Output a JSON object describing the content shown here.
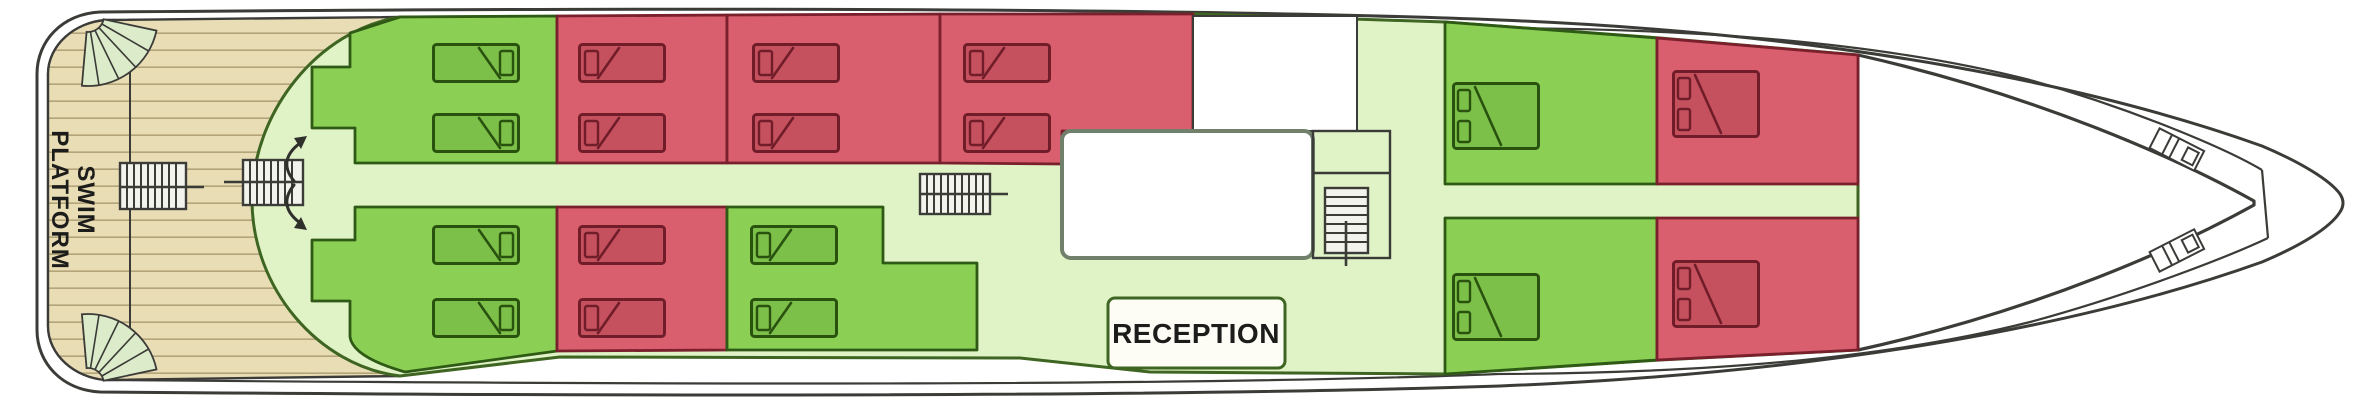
{
  "labels": {
    "swim_platform_line1": "SWIM",
    "swim_platform_line2": "PLATFORM",
    "reception": "RECEPTION"
  },
  "colors": {
    "hull_stroke": "#3b3b38",
    "deck_wood": "#e9ddb6",
    "deck_plank_line": "#b3a47a",
    "corridor": "#e0f3c6",
    "superstructure_stroke": "#3f6522",
    "cabin_green": "#8bd054",
    "cabin_green_stroke": "#2f5a15",
    "bed_green": "#7cbf49",
    "bed_green_stroke": "#2a520f",
    "cabin_red": "#d95f6f",
    "cabin_red_stroke": "#7a1f2c",
    "bed_red": "#c5515f",
    "bed_red_stroke": "#711d29",
    "stairs_fill": "#f2f3ec",
    "fan_fill": "#dcecca",
    "room_b_stroke": "#71806a",
    "reception_border": "#3f6522",
    "label_text": "#1c1c1a"
  },
  "deck": {
    "cabins": [
      {
        "area": "aft",
        "row": "top",
        "index": 1,
        "color": "green",
        "beds": "2 singles"
      },
      {
        "area": "aft",
        "row": "top",
        "index": 2,
        "color": "red",
        "beds": "2 singles"
      },
      {
        "area": "aft",
        "row": "top",
        "index": 3,
        "color": "red",
        "beds": "2 singles"
      },
      {
        "area": "aft",
        "row": "top",
        "index": 4,
        "color": "red",
        "beds": "2 singles"
      },
      {
        "area": "aft",
        "row": "bottom",
        "index": 1,
        "color": "green",
        "beds": "2 singles"
      },
      {
        "area": "aft",
        "row": "bottom",
        "index": 2,
        "color": "red",
        "beds": "2 singles"
      },
      {
        "area": "aft",
        "row": "bottom",
        "index": 3,
        "color": "green",
        "beds": "2 singles"
      },
      {
        "area": "forward",
        "row": "top",
        "index": 1,
        "color": "green",
        "beds": "1 double"
      },
      {
        "area": "forward",
        "row": "top",
        "index": 2,
        "color": "red",
        "beds": "1 double"
      },
      {
        "area": "forward",
        "row": "bottom",
        "index": 1,
        "color": "green",
        "beds": "1 double"
      },
      {
        "area": "forward",
        "row": "bottom",
        "index": 2,
        "color": "red",
        "beds": "1 double"
      }
    ],
    "features": [
      "swim-platform",
      "stern-fan-stairs x2",
      "aft-deck-companionway x2",
      "lobby-swing-door-arrows",
      "midship-staircase",
      "forward-staircase",
      "reception",
      "bow-mooring-fittings x2"
    ]
  }
}
